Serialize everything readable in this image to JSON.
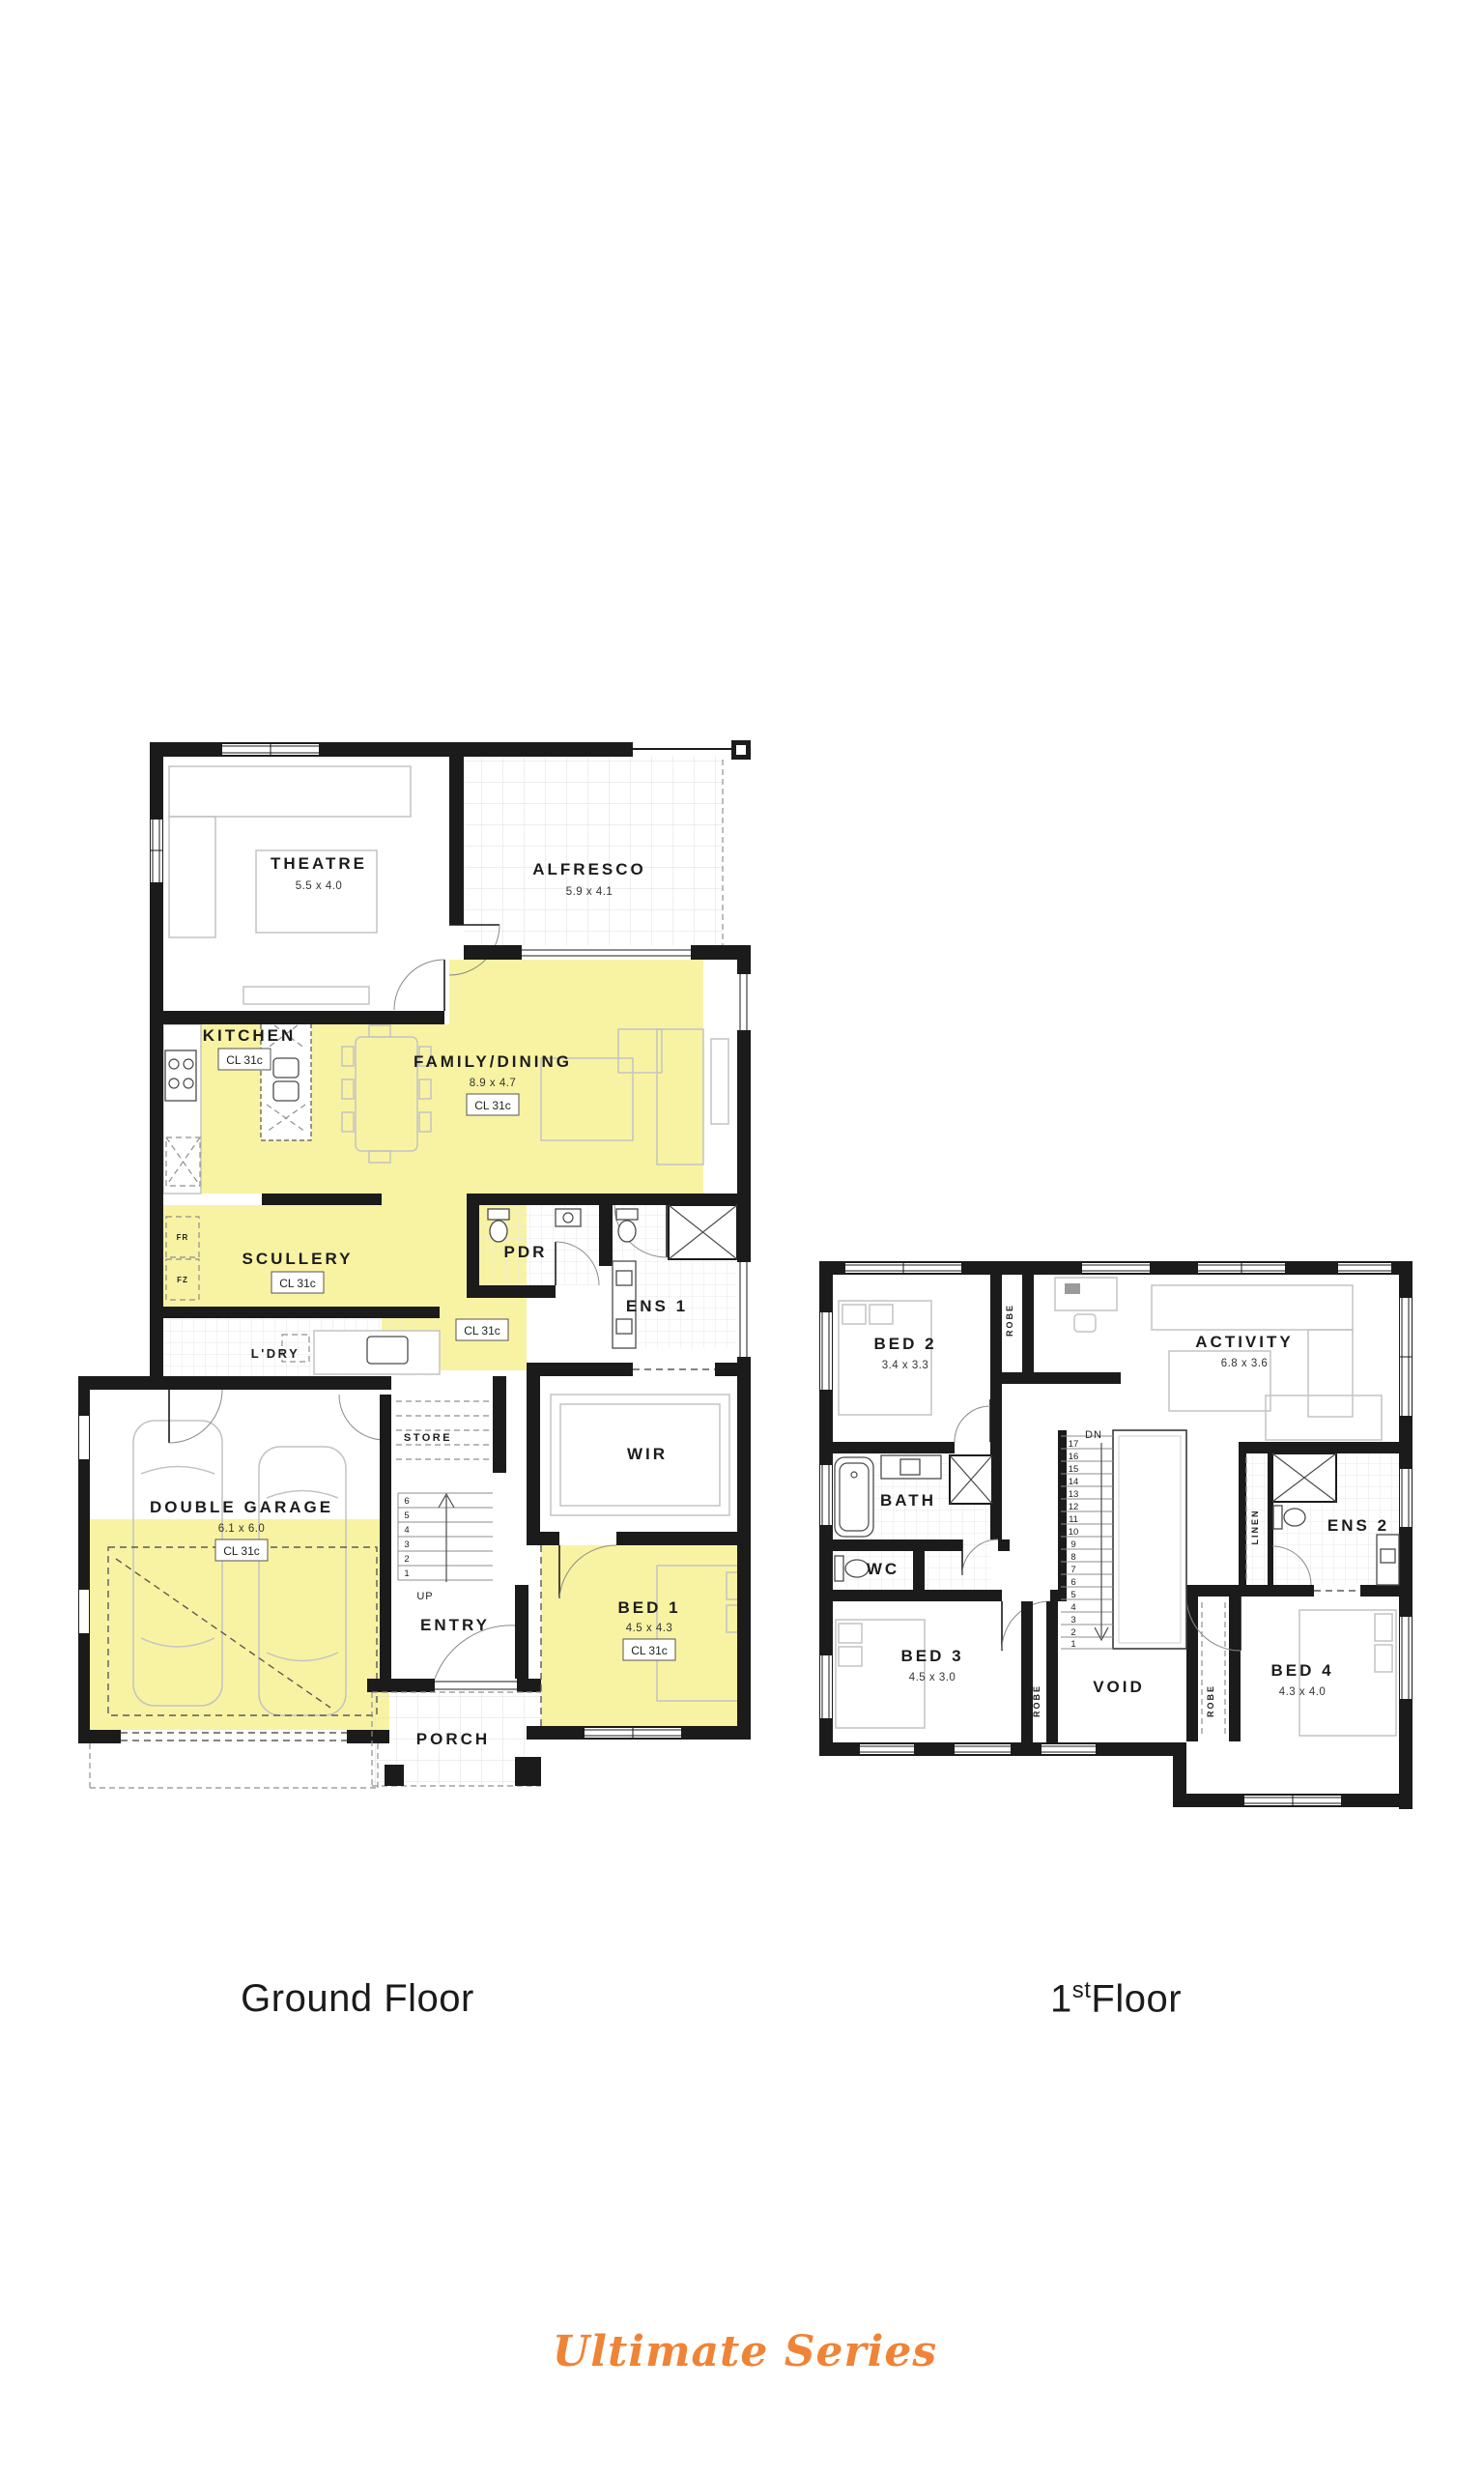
{
  "captions": {
    "ground": "Ground Floor",
    "first_num": "1",
    "first_sup": "st",
    "first_word": "Floor"
  },
  "logo": {
    "text": "Ultimate Series",
    "color": "#EF8437"
  },
  "palette": {
    "wall": "#1b1b1b",
    "highlight": "#F8F3A3",
    "logo_orange": "#EF8437"
  },
  "gf": {
    "theatre": {
      "n": "THEATRE",
      "d": "5.5 x 4.0"
    },
    "alfresco": {
      "n": "ALFRESCO",
      "d": "5.9 x 4.1"
    },
    "kitchen": {
      "n": "KITCHEN",
      "cl": "CL 31c"
    },
    "family": {
      "n": "FAMILY/DINING",
      "d": "8.9 x 4.7",
      "cl": "CL 31c"
    },
    "scullery": {
      "n": "SCULLERY",
      "cl": "CL 31c"
    },
    "fr": "FR",
    "fz": "FZ",
    "ldry": {
      "n": "L'DRY"
    },
    "pdr": {
      "n": "PDR"
    },
    "ens1": {
      "n": "ENS 1"
    },
    "hall": {
      "cl": "CL 31c"
    },
    "store": {
      "n": "STORE"
    },
    "wir": {
      "n": "WIR"
    },
    "garage": {
      "n": "DOUBLE GARAGE",
      "d": "6.1 x 6.0",
      "cl": "CL 31c"
    },
    "entry": {
      "n": "ENTRY"
    },
    "up": "UP",
    "bed1": {
      "n": "BED 1",
      "d": "4.5 x 4.3",
      "cl": "CL 31c"
    },
    "porch": {
      "n": "PORCH"
    },
    "stairs": [
      "6",
      "5",
      "4",
      "3",
      "2",
      "1"
    ]
  },
  "ff": {
    "bed2": {
      "n": "BED 2",
      "d": "3.4 x 3.3"
    },
    "robe": "ROBE",
    "activity": {
      "n": "ACTIVITY",
      "d": "6.8 x 3.6"
    },
    "bath": {
      "n": "BATH"
    },
    "wc": {
      "n": "WC"
    },
    "dn": "DN",
    "linen": "LINEN",
    "ens2": {
      "n": "ENS 2"
    },
    "bed3": {
      "n": "BED 3",
      "d": "4.5 x 3.0"
    },
    "void": {
      "n": "VOID"
    },
    "bed4": {
      "n": "BED 4",
      "d": "4.3 x 4.0"
    },
    "stairs": [
      "17",
      "16",
      "15",
      "14",
      "13",
      "12",
      "11",
      "10",
      "9",
      "8",
      "7",
      "6",
      "5",
      "4",
      "3",
      "2",
      "1"
    ]
  }
}
